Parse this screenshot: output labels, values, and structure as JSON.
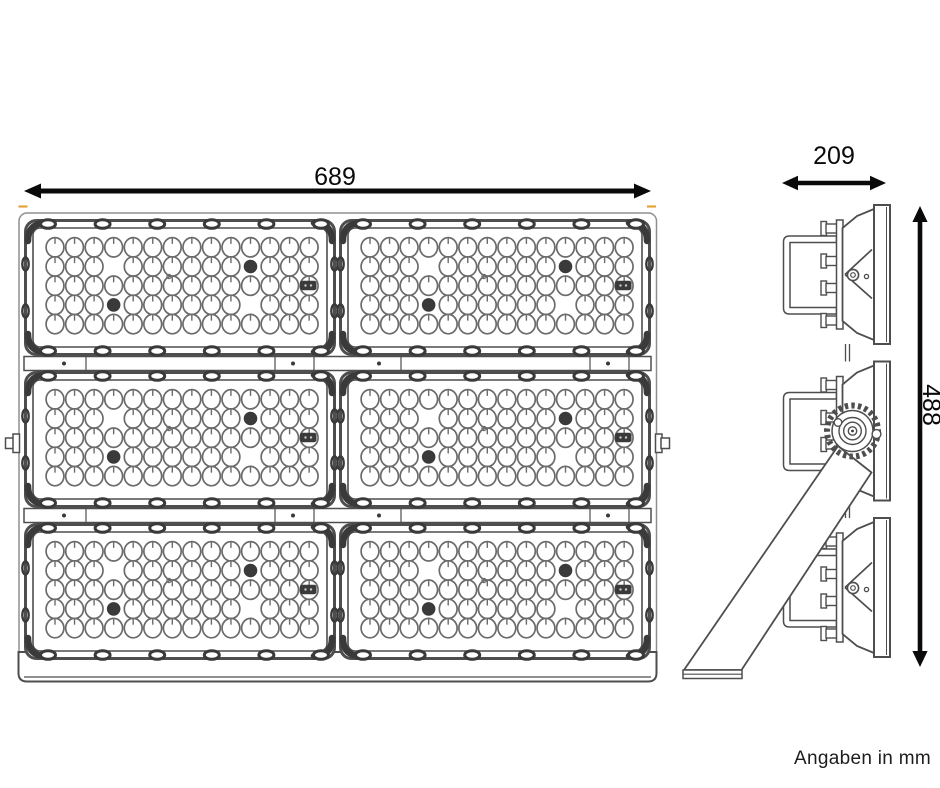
{
  "note": "Angaben in mm",
  "dimensions": {
    "front_width": "689",
    "side_depth": "209",
    "side_height": "488"
  },
  "colors": {
    "line": "#4e4e4e",
    "dark": "#3a3a3a",
    "led_stroke": "#6b6b6b",
    "dimension": "#0a0a0a",
    "tick_accent": "#e7a33b",
    "text": "#1d1d1d",
    "background": "#ffffff"
  },
  "front_view": {
    "grid": {
      "columns": 2,
      "rows": 3
    },
    "led_module": {
      "led_columns": 14,
      "led_rows": 5,
      "rows_pattern": [
        {
          "row": 2,
          "missing": [
            4
          ],
          "dark_led": [
            11
          ]
        },
        {
          "row": 4,
          "missing": [
            11
          ],
          "dark_led": [
            4
          ]
        }
      ],
      "id_plate_row": 3,
      "pinhole": true
    }
  },
  "side_view": {
    "modules": 3
  }
}
